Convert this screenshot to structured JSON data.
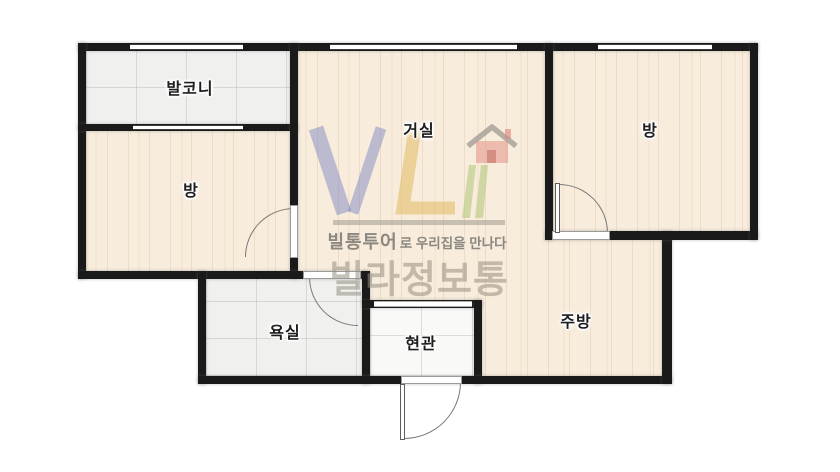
{
  "brand": {
    "logo": "VL",
    "tagline_brand": "빌통투어",
    "tagline_rest": "로 우리집을 만나다",
    "name_large": "빌라정보통",
    "colors": {
      "logo_v_blue": "#8089c2",
      "logo_l_yellow": "#e0ba60",
      "logo_house_red": "#e39388",
      "logo_green": "#b7ca7e",
      "logo_roof_gray": "#8f8e87",
      "tagline_gray": "#78776f",
      "name_gray": "#968f84"
    }
  },
  "rooms": [
    {
      "id": "balcony",
      "label": "발코니"
    },
    {
      "id": "room-left",
      "label": "방"
    },
    {
      "id": "living",
      "label": "거실"
    },
    {
      "id": "room-right",
      "label": "방"
    },
    {
      "id": "bathroom",
      "label": "욕실"
    },
    {
      "id": "entrance",
      "label": "현관"
    },
    {
      "id": "kitchen",
      "label": "주방"
    }
  ],
  "palette": {
    "wall": "#1a1a1a",
    "wood_floor": "#f8ecdc",
    "tile_floor": "#f0f0ee",
    "entry_floor": "#f9f9f8",
    "door_arc": "#7a7a7a"
  }
}
